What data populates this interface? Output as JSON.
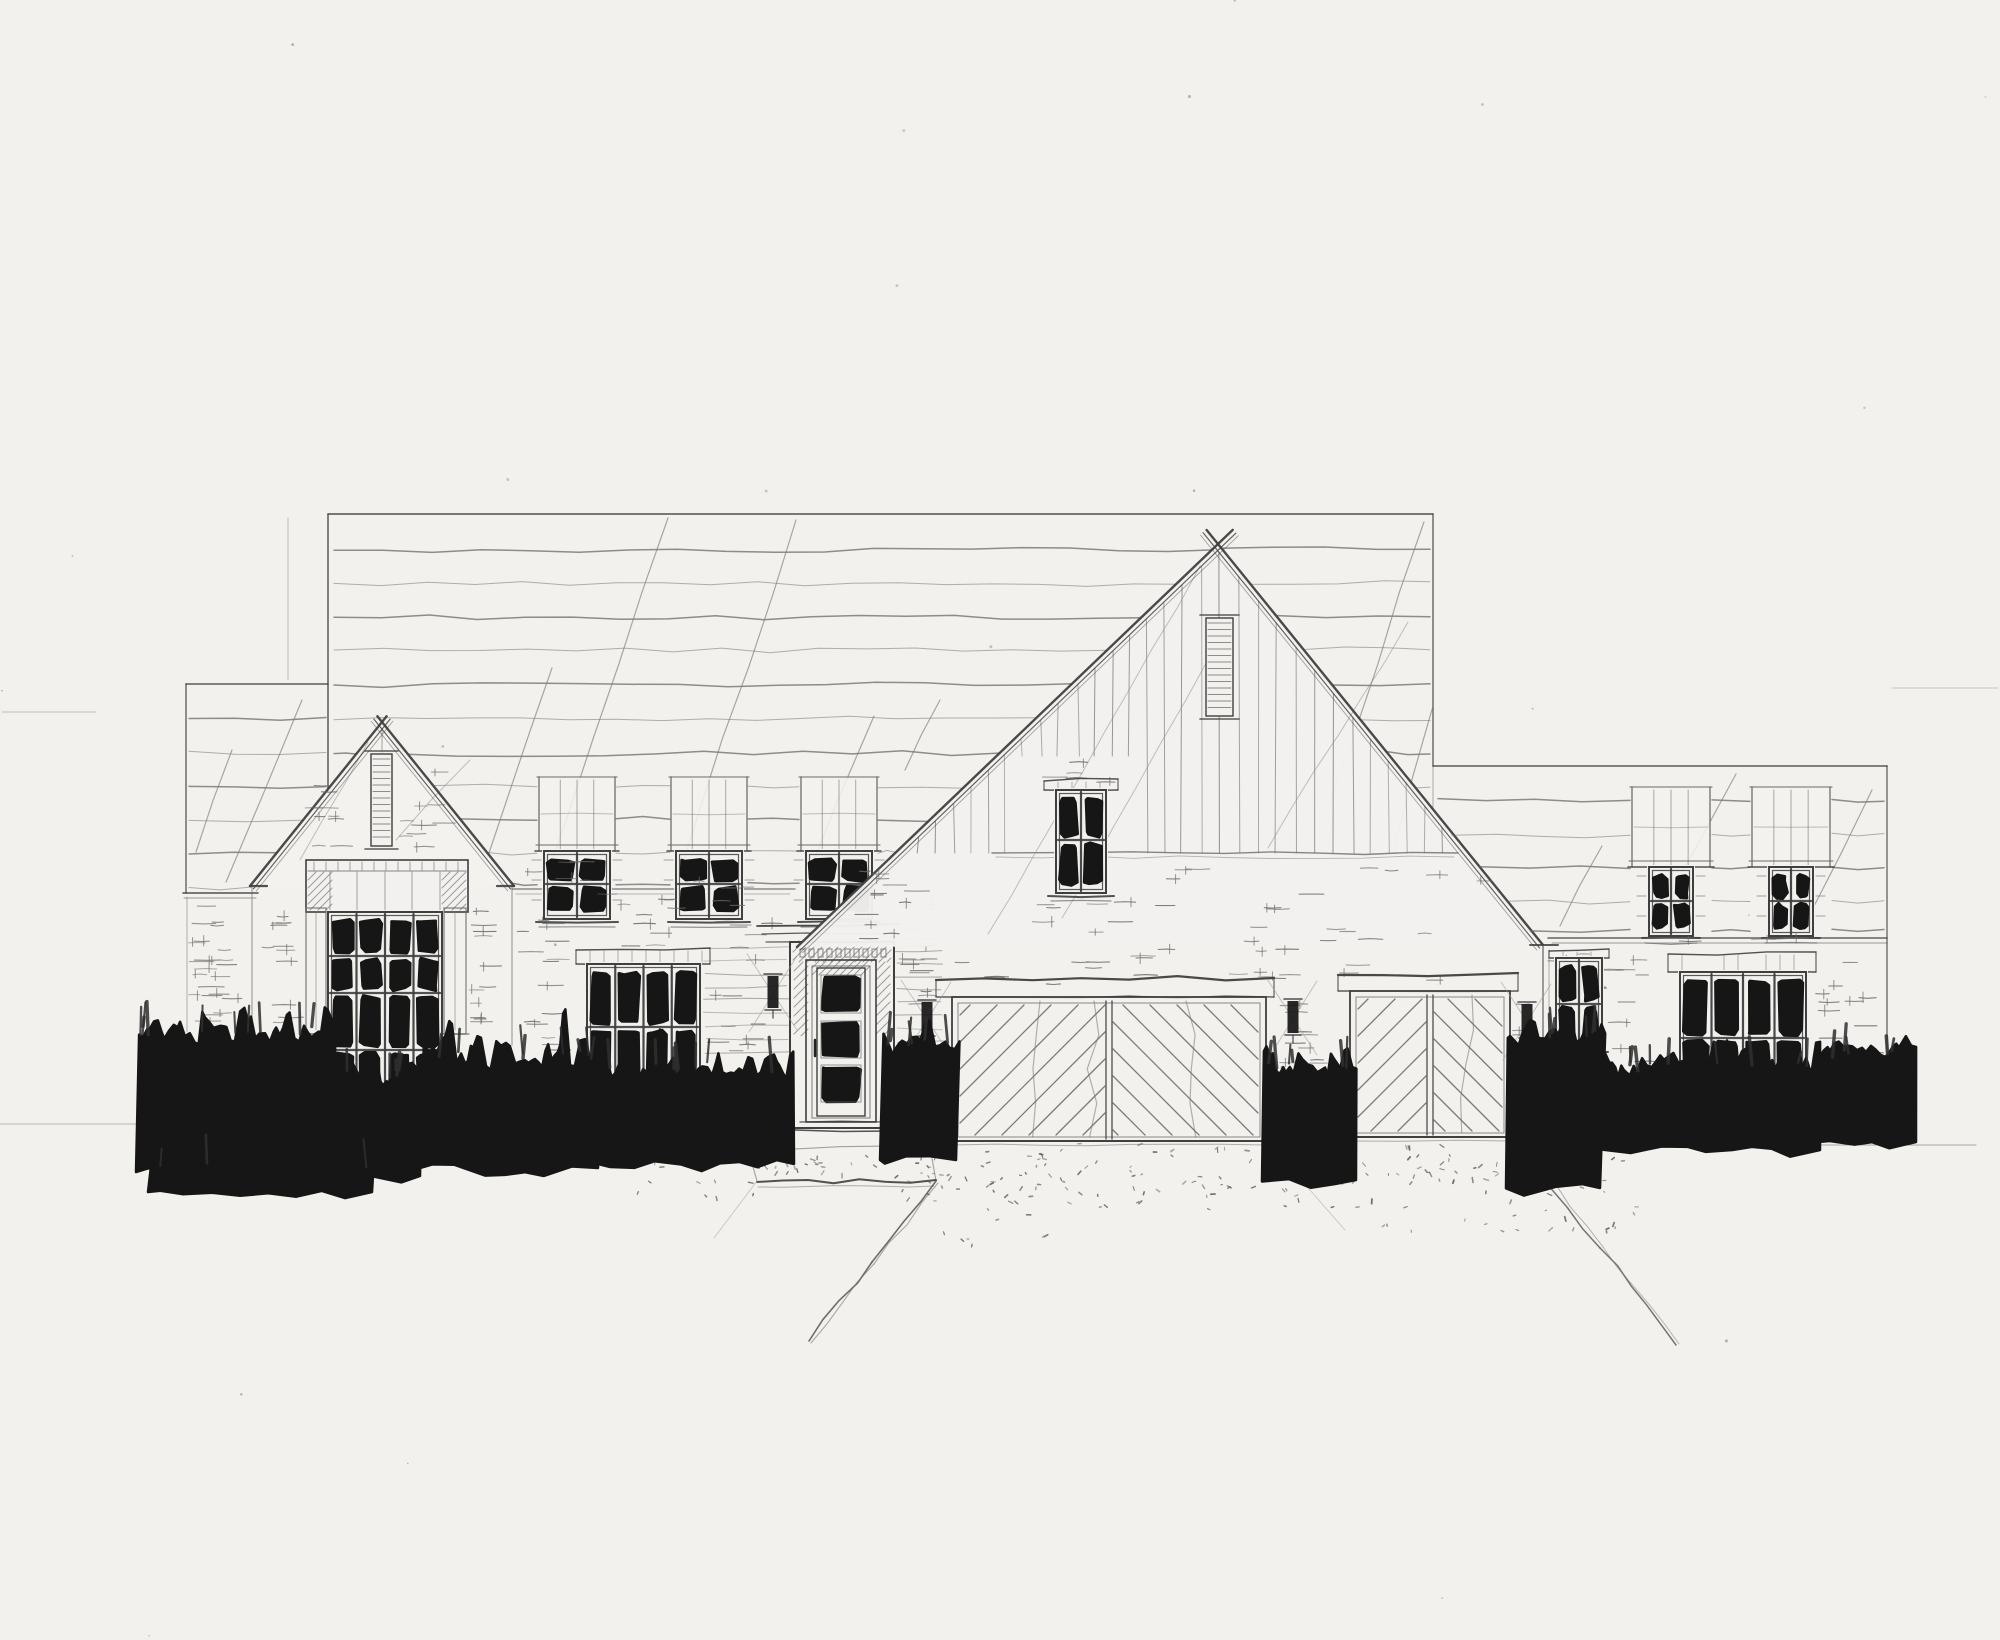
{
  "meta": {
    "title": "Pencil front-elevation sketch of a single-family house",
    "medium": "pencil on paper"
  },
  "canvas": {
    "width": 2000,
    "height": 1640
  },
  "palette": {
    "paper": "#f2f1ee",
    "pencil": "#6a6a6a",
    "pencil_light": "#9b9b9b",
    "pencil_dark": "#3f3f3f",
    "ink": "#161616"
  },
  "components": [
    {
      "name": "paper-speckles",
      "type": "speckles",
      "n": 30
    },
    {
      "name": "margin-guide-lines",
      "type": "lines",
      "lines": [
        [
          2,
          712,
          96,
          712,
          1,
          0.38
        ],
        [
          0,
          1124,
          146,
          1124,
          1,
          0.42
        ],
        [
          1892,
          688,
          1998,
          688,
          1,
          0.35
        ],
        [
          1614,
          1145,
          1976,
          1145,
          1.1,
          0.55
        ]
      ]
    },
    {
      "name": "main-roof",
      "type": "roof",
      "edges": [
        [
          328,
          514,
          1433,
          514,
          1.6,
          0.9
        ],
        [
          328,
          514,
          328,
          790,
          1.5,
          0.85
        ],
        [
          1433,
          514,
          1433,
          766,
          1.4,
          0.8
        ],
        [
          1433,
          766,
          1433,
          808,
          1,
          0.4
        ],
        [
          288,
          518,
          288,
          680,
          1,
          0.3
        ]
      ],
      "shingles": {
        "x0": 334,
        "x1": 1430,
        "ys": [
          549,
          583,
          617,
          651,
          685,
          719,
          753,
          787,
          820,
          852,
          884
        ]
      },
      "clips": [
        {
          "ax": 1218,
          "ay": 548,
          "kl": 1.058,
          "kr": 0.818
        },
        {
          "ax": 382,
          "ay": 722,
          "kl": 0.8,
          "kr": 0.8
        },
        {
          "x0": 537,
          "x1": 616,
          "y0": 777,
          "y1": 924
        },
        {
          "x0": 670,
          "x1": 748,
          "y0": 777,
          "y1": 924
        },
        {
          "x0": 799,
          "x1": 878,
          "y0": 777,
          "y1": 924
        }
      ],
      "diagonals": [
        [
          544,
          884,
          668,
          518
        ],
        [
          676,
          884,
          796,
          520
        ],
        [
          806,
          880,
          874,
          716
        ],
        [
          486,
          862,
          552,
          668
        ],
        [
          1330,
          804,
          1424,
          522
        ],
        [
          1394,
          848,
          1433,
          706
        ],
        [
          905,
          770,
          940,
          700
        ]
      ]
    },
    {
      "name": "left-wing-roof",
      "type": "roof",
      "edges": [
        [
          186,
          684,
          328,
          684,
          1.5,
          0.85
        ],
        [
          186,
          684,
          186,
          893,
          1.4,
          0.8
        ],
        [
          183,
          893,
          258,
          893,
          1.6,
          0.9
        ],
        [
          184,
          898,
          256,
          898,
          1,
          0.5
        ]
      ],
      "shingles": {
        "x0": 189,
        "x1": 326,
        "ys": [
          718,
          752,
          786,
          820,
          854,
          886
        ]
      },
      "clips": [
        {
          "ax": 382,
          "ay": 722,
          "kl": 0.8,
          "kr": 0.8
        }
      ],
      "diagonals": [
        [
          226,
          882,
          302,
          700
        ],
        [
          196,
          852,
          232,
          750
        ]
      ]
    },
    {
      "name": "left-wing-wall-courses",
      "type": "dashes",
      "regions": [
        {
          "x0": 188,
          "x1": 250,
          "y0": 906,
          "y1": 1028,
          "n": 22
        }
      ]
    },
    {
      "name": "wall-corner-lines",
      "type": "lines",
      "lines": [
        [
          187,
          897,
          187,
          1032,
          1,
          0.5
        ],
        [
          252,
          886,
          252,
          1040,
          1.2,
          0.6
        ],
        [
          512,
          886,
          512,
          1045,
          1.2,
          0.6
        ],
        [
          512,
          889,
          795,
          889,
          1.4,
          0.75
        ],
        [
          516,
          894,
          790,
          894,
          1,
          0.45
        ]
      ]
    },
    {
      "name": "left-gable",
      "type": "gable",
      "apex": [
        382,
        722
      ],
      "baseL": [
        250,
        886
      ],
      "baseR": [
        514,
        886
      ],
      "louver": {
        "x0": 371,
        "x1": 392,
        "y0": 754,
        "y1": 846
      },
      "apexTick": [
        382,
        728,
        382,
        752
      ],
      "returns": [
        [
          250,
          886,
          267,
          886
        ],
        [
          497,
          886,
          514,
          886
        ]
      ],
      "diagonals": [
        [
          300,
          860,
          368,
          742
        ],
        [
          396,
          840,
          470,
          760
        ]
      ]
    },
    {
      "name": "left-gable-face-bricks",
      "type": "dashes",
      "regions": [
        {
          "x0": 300,
          "x1": 366,
          "y0": 772,
          "y1": 852,
          "n": 9
        },
        {
          "x0": 398,
          "x1": 466,
          "y0": 772,
          "y1": 852,
          "n": 9
        },
        {
          "x0": 262,
          "x1": 304,
          "y0": 898,
          "y1": 1030,
          "n": 11
        },
        {
          "x0": 468,
          "x1": 508,
          "y0": 898,
          "y1": 1030,
          "n": 11
        }
      ]
    },
    {
      "name": "left-gable-window-header",
      "type": "panelHeader",
      "x0": 306,
      "x1": 468,
      "y0": 860,
      "y1": 912,
      "verticals": [
        330,
        357,
        385,
        412,
        440
      ]
    },
    {
      "name": "left-gable-window",
      "type": "window",
      "x": 328,
      "y": 912,
      "w": 114,
      "h": 190,
      "cols": 4,
      "rowLines": [
        956,
        993,
        1050
      ],
      "sill": {
        "x0": 320,
        "x1": 450,
        "y": 1104
      },
      "pilasters": {
        "xs": [
          [
            306,
            326
          ],
          [
            444,
            466
          ]
        ],
        "y0": 908,
        "y1": 1034
      }
    },
    {
      "name": "upper-dormer-1",
      "type": "dormer",
      "x0": 539,
      "shaftW": 76,
      "shaftY0": 777,
      "shaftY1": 851,
      "win": {
        "x": 544,
        "y": 851,
        "w": 66,
        "h": 68,
        "cols": 2,
        "rowLines": [
          884
        ],
        "sill": {
          "x0": 536,
          "x1": 618,
          "y": 922
        }
      }
    },
    {
      "name": "upper-dormer-2",
      "type": "dormer",
      "x0": 671,
      "shaftW": 76,
      "shaftY0": 777,
      "shaftY1": 851,
      "win": {
        "x": 676,
        "y": 851,
        "w": 66,
        "h": 68,
        "cols": 2,
        "rowLines": [
          884
        ],
        "sill": {
          "x0": 668,
          "x1": 750,
          "y": 922
        }
      }
    },
    {
      "name": "upper-dormer-3",
      "type": "dormer",
      "x0": 801,
      "shaftW": 76,
      "shaftY0": 777,
      "shaftY1": 851,
      "win": {
        "x": 806,
        "y": 851,
        "w": 66,
        "h": 68,
        "cols": 2,
        "rowLines": [
          884
        ],
        "sill": {
          "x0": 798,
          "x1": 880,
          "y": 922
        }
      }
    },
    {
      "name": "mid-wall-bricks",
      "type": "dashes",
      "regions": [
        {
          "x0": 516,
          "x1": 576,
          "y0": 900,
          "y1": 1078,
          "n": 15
        },
        {
          "x0": 706,
          "x1": 786,
          "y0": 900,
          "y1": 1055,
          "n": 16
        },
        {
          "x0": 580,
          "x1": 700,
          "y0": 898,
          "y1": 946,
          "n": 8
        },
        {
          "x0": 584,
          "x1": 702,
          "y0": 1098,
          "y1": 1128,
          "n": 5
        },
        {
          "x0": 898,
          "x1": 950,
          "y0": 900,
          "y1": 1126,
          "n": 14
        },
        {
          "x0": 516,
          "x1": 792,
          "y0": 848,
          "y1": 894,
          "n": 9
        }
      ]
    },
    {
      "name": "door-flank-siding",
      "type": "hlines",
      "regions": [
        {
          "x0": 704,
          "x1": 788,
          "y0": 948,
          "y1": 1058,
          "step": 13
        },
        {
          "x0": 896,
          "x1": 942,
          "y0": 938,
          "y1": 1096,
          "step": 13
        }
      ]
    },
    {
      "name": "lower-left-window",
      "type": "window",
      "x": 587,
      "y": 964,
      "w": 113,
      "h": 126,
      "cols": 4,
      "rowLines": [
        1027
      ],
      "header": {
        "x0": 576,
        "x1": 710,
        "y0": 948,
        "y1": 964
      },
      "sill": {
        "x0": 578,
        "x1": 708,
        "y": 1092
      }
    },
    {
      "name": "front-door",
      "type": "door"
    },
    {
      "name": "center-gable",
      "type": "centerGable",
      "apex": [
        1218,
        544
      ],
      "baseL": [
        797,
        947
      ],
      "baseR": [
        1543,
        945
      ],
      "louver": {
        "x0": 1206,
        "x1": 1233,
        "y0": 618,
        "y1": 716
      },
      "siding": {
        "x0": 902,
        "x1": 1456,
        "step": 18,
        "yBottom": 853,
        "patch": {
          "x0": 1016,
          "x1": 1144,
          "yBottom": 756
        }
      },
      "transition": [
        992,
        853,
        1458,
        853
      ],
      "diagonals": [
        [
          988,
          934,
          1200,
          566
        ],
        [
          1062,
          918,
          1210,
          656
        ],
        [
          1268,
          848,
          1408,
          622
        ]
      ],
      "returns": [
        [
          1530,
          945,
          1558,
          945
        ]
      ]
    },
    {
      "name": "center-gable-bricks",
      "type": "dashes",
      "regions": [
        {
          "x0": 836,
          "x1": 1008,
          "y0": 868,
          "y1": 944,
          "n": 12
        },
        {
          "x0": 1152,
          "x1": 1526,
          "y0": 860,
          "y1": 942,
          "n": 18
        },
        {
          "x0": 1018,
          "x1": 1142,
          "y0": 758,
          "y1": 786,
          "n": 5
        },
        {
          "x0": 1012,
          "x1": 1148,
          "y0": 902,
          "y1": 944,
          "n": 7
        }
      ]
    },
    {
      "name": "center-gable-window",
      "type": "window",
      "x": 1056,
      "y": 790,
      "w": 50,
      "h": 103,
      "cols": 2,
      "rowLines": [
        840
      ],
      "header": {
        "x0": 1044,
        "x1": 1118,
        "y0": 779,
        "y1": 790
      },
      "sill": {
        "x0": 1048,
        "x1": 1114,
        "y": 896
      }
    },
    {
      "name": "garage-wall-bricks",
      "type": "dashes",
      "regions": [
        {
          "x0": 902,
          "x1": 1536,
          "y0": 948,
          "y1": 984,
          "n": 22
        },
        {
          "x0": 1274,
          "x1": 1348,
          "y0": 1002,
          "y1": 1128,
          "n": 15
        },
        {
          "x0": 1512,
          "x1": 1542,
          "y0": 998,
          "y1": 1136,
          "n": 8
        }
      ]
    },
    {
      "name": "garage-door-left",
      "type": "garage",
      "x0": 952,
      "x1": 1266,
      "y0": 997,
      "y1": 1141,
      "cx": 1109,
      "header": {
        "x0": 936,
        "x1": 1274,
        "y0": 980,
        "y1": 997
      },
      "step": 27,
      "waves": [
        1040,
        1094,
        1186
      ]
    },
    {
      "name": "garage-door-right",
      "type": "garage",
      "x0": 1350,
      "x1": 1510,
      "y0": 991,
      "y1": 1137,
      "cx": 1430,
      "header": {
        "x0": 1338,
        "x1": 1518,
        "y0": 975,
        "y1": 991
      },
      "step": 27,
      "waves": [
        1472
      ]
    },
    {
      "name": "garage-corner-trim",
      "type": "lines",
      "lines": [
        [
          1543,
          946,
          1543,
          1062,
          1.5,
          0.85
        ],
        [
          1549,
          950,
          1549,
          1058,
          1,
          0.5
        ]
      ]
    },
    {
      "name": "right-wing-roof",
      "type": "roof",
      "edges": [
        [
          1433,
          766,
          1887,
          766,
          1.5,
          0.85
        ],
        [
          1887,
          766,
          1887,
          1058,
          1.4,
          0.75
        ],
        [
          1548,
          938,
          1887,
          938,
          1.5,
          0.8
        ],
        [
          1552,
          943,
          1887,
          943,
          1,
          0.5
        ]
      ],
      "shingles": {
        "x0": 1438,
        "x1": 1884,
        "ys": [
          800,
          834,
          868,
          902,
          930
        ]
      },
      "clips": [
        {
          "ax": 1218,
          "ay": 548,
          "kl": 1.058,
          "kr": 0.818
        },
        {
          "x0": 1630,
          "x1": 1712,
          "y0": 787,
          "y1": 940
        },
        {
          "x0": 1750,
          "x1": 1832,
          "y0": 787,
          "y1": 940
        }
      ],
      "diagonals": [
        [
          1650,
          928,
          1736,
          774
        ],
        [
          1560,
          926,
          1602,
          846
        ],
        [
          1812,
          910,
          1872,
          790
        ]
      ]
    },
    {
      "name": "right-dormer-1",
      "type": "dormer",
      "x0": 1632,
      "shaftW": 78,
      "shaftY0": 787,
      "shaftY1": 867,
      "win": {
        "x": 1649,
        "y": 867,
        "w": 44,
        "h": 69,
        "cols": 2,
        "rowLines": [
          901
        ],
        "sill": {
          "x0": 1642,
          "x1": 1700,
          "y": 938
        }
      }
    },
    {
      "name": "right-dormer-2",
      "type": "dormer",
      "x0": 1752,
      "shaftW": 78,
      "shaftY0": 787,
      "shaftY1": 867,
      "win": {
        "x": 1769,
        "y": 867,
        "w": 44,
        "h": 69,
        "cols": 2,
        "rowLines": [
          901
        ],
        "sill": {
          "x0": 1762,
          "x1": 1820,
          "y": 938
        }
      }
    },
    {
      "name": "right-wall-bricks",
      "type": "dashes",
      "regions": [
        {
          "x0": 1548,
          "x1": 1662,
          "y0": 948,
          "y1": 1058,
          "n": 14
        },
        {
          "x0": 1610,
          "x1": 1670,
          "y0": 1058,
          "y1": 1098,
          "n": 5
        },
        {
          "x0": 1814,
          "x1": 1884,
          "y0": 948,
          "y1": 1086,
          "n": 12
        },
        {
          "x0": 1662,
          "x1": 1814,
          "y0": 938,
          "y1": 950,
          "n": 4
        }
      ]
    },
    {
      "name": "right-small-window",
      "type": "window",
      "x": 1556,
      "y": 958,
      "w": 46,
      "h": 92,
      "cols": 2,
      "rowLines": [
        1004
      ],
      "header": {
        "x0": 1549,
        "x1": 1609,
        "y0": 949,
        "y1": 958
      },
      "sill": {
        "x0": 1550,
        "x1": 1608,
        "y": 1052
      }
    },
    {
      "name": "right-large-window",
      "type": "window",
      "x": 1680,
      "y": 972,
      "w": 126,
      "h": 128,
      "cols": 4,
      "rowLines": [
        1038
      ],
      "header": {
        "x0": 1668,
        "x1": 1816,
        "y0": 952,
        "y1": 972
      },
      "sill": {
        "x0": 1674,
        "x1": 1812,
        "y": 1102
      }
    },
    {
      "name": "wall-sconces",
      "type": "sconces",
      "items": [
        [
          773,
          974
        ],
        [
          927,
          1000
        ],
        [
          1293,
          999
        ],
        [
          1527,
          1002
        ]
      ]
    },
    {
      "name": "front-walkway",
      "type": "walk"
    },
    {
      "name": "driveway-edges",
      "type": "edges"
    },
    {
      "name": "driveway-stipple",
      "type": "stipple",
      "regions": [
        {
          "x0": 892,
          "x1": 1538,
          "y0": 1142,
          "y1": 1210,
          "n": 150
        },
        {
          "x0": 762,
          "x1": 934,
          "y0": 1152,
          "y1": 1178,
          "n": 26
        },
        {
          "x0": 1545,
          "x1": 1642,
          "y0": 1150,
          "y1": 1232,
          "n": 24
        },
        {
          "x0": 624,
          "x1": 760,
          "y0": 1162,
          "y1": 1204,
          "n": 12
        },
        {
          "x0": 938,
          "x1": 1060,
          "y0": 1212,
          "y1": 1248,
          "n": 8
        },
        {
          "x0": 1360,
          "x1": 1520,
          "y0": 1210,
          "y1": 1240,
          "n": 8
        }
      ]
    },
    {
      "name": "shrub-row",
      "type": "bushes",
      "clusters": [
        {
          "x0": 136,
          "x1": 332,
          "yt": 1026,
          "yb": 1172,
          "sp": 0.14,
          "n1": 10
        },
        {
          "x0": 318,
          "x1": 420,
          "yt": 1068,
          "yb": 1176,
          "sp": 0.1,
          "n1": 5
        },
        {
          "x0": 148,
          "x1": 372,
          "yt": 1158,
          "yb": 1192,
          "sp": 0.02,
          "n1": 3
        },
        {
          "x0": 420,
          "x1": 598,
          "yt": 1050,
          "yb": 1168,
          "sp": 0.12,
          "n1": 8
        },
        {
          "x0": 598,
          "x1": 794,
          "yt": 1062,
          "yb": 1164,
          "sp": 0.1,
          "n1": 8
        },
        {
          "x0": 880,
          "x1": 956,
          "yt": 1038,
          "yb": 1160,
          "sp": 0.2,
          "n1": 6
        },
        {
          "x0": 1262,
          "x1": 1356,
          "yt": 1060,
          "yb": 1180,
          "sp": 0.16,
          "n1": 6
        },
        {
          "x0": 1506,
          "x1": 1600,
          "yt": 1028,
          "yb": 1188,
          "sp": 0.18,
          "n1": 6
        },
        {
          "x0": 1598,
          "x1": 1820,
          "yt": 1062,
          "yb": 1150,
          "sp": 0.1,
          "n1": 9
        },
        {
          "x0": 1818,
          "x1": 1916,
          "yt": 1048,
          "yb": 1142,
          "sp": 0.12,
          "n1": 5
        }
      ]
    }
  ]
}
